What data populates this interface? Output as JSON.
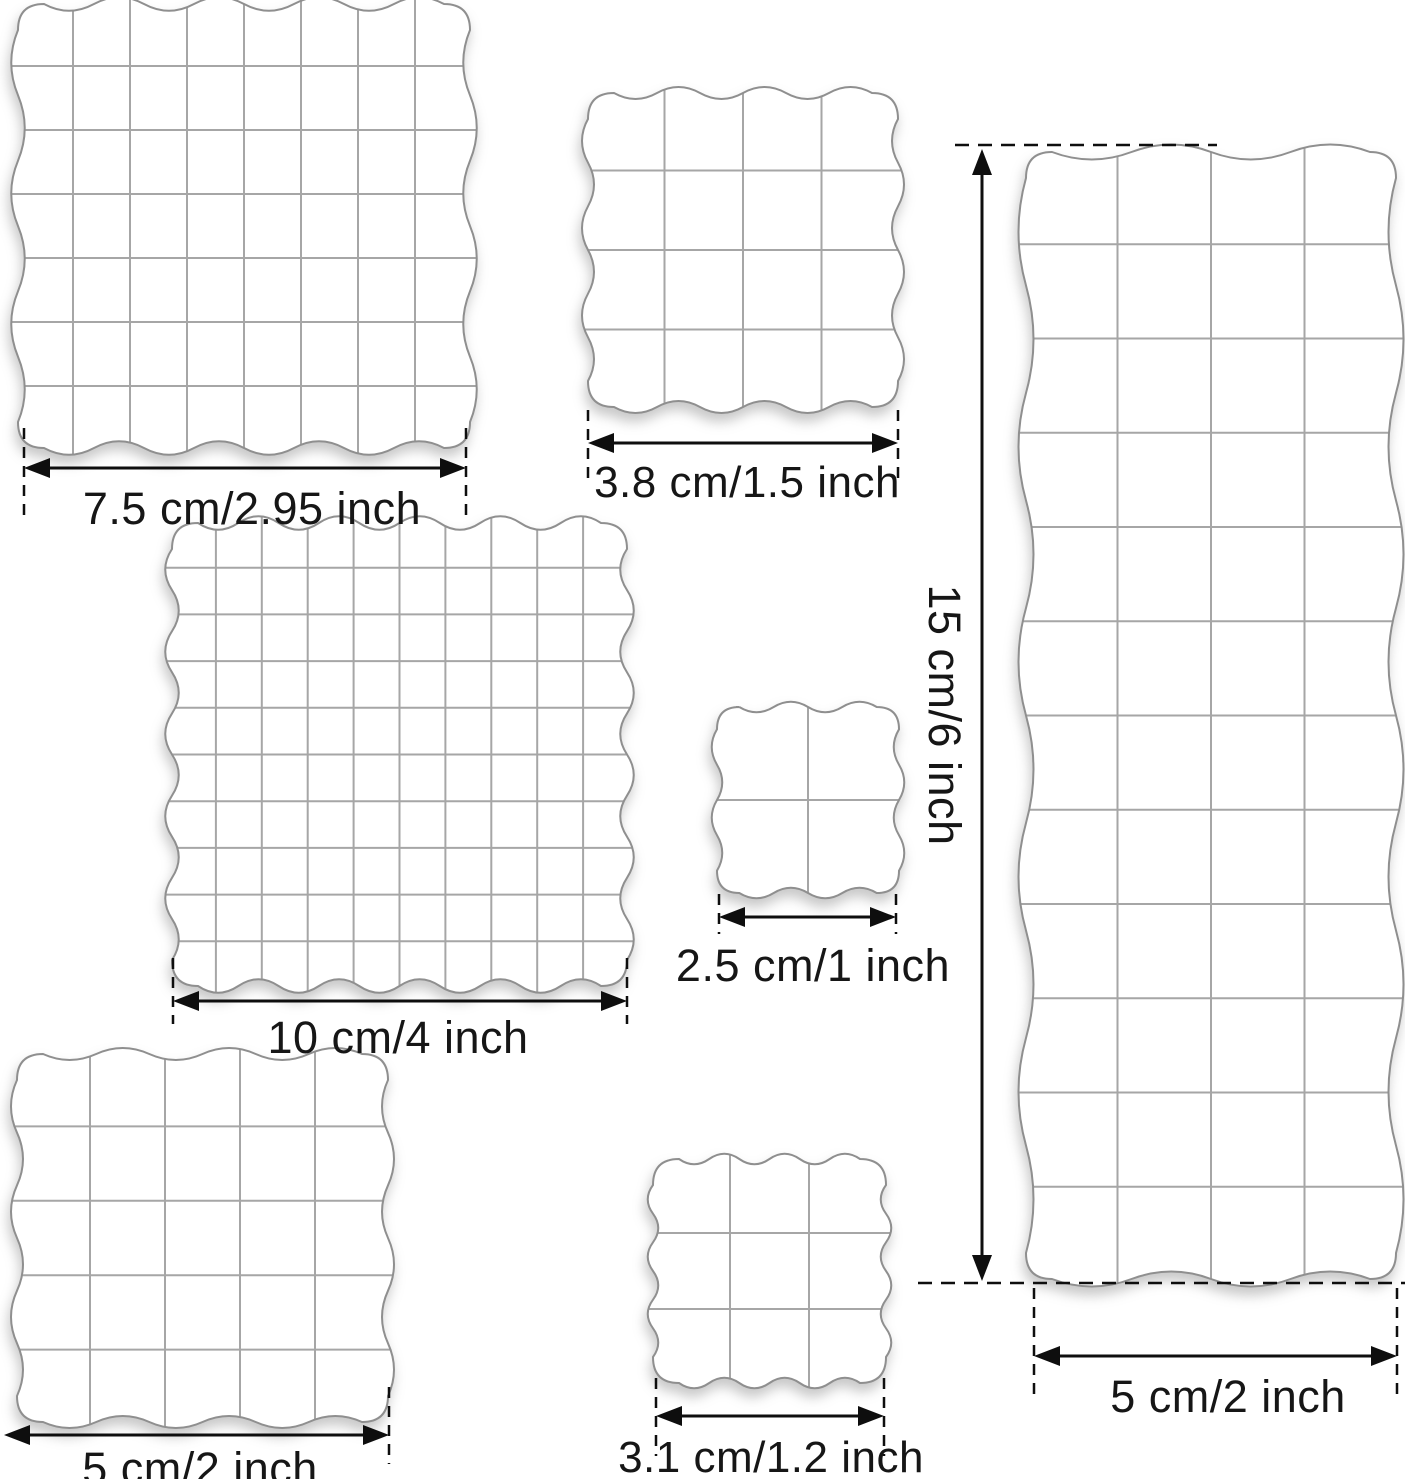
{
  "colors": {
    "background": "#ffffff",
    "line": "#0e0e0e",
    "grid": "#a6a6a6",
    "outline": "#8f8f8f",
    "block_fill": "#ffffff"
  },
  "blocks": [
    {
      "name": "block-7-5-cm",
      "x": 16,
      "y": 2,
      "w": 456,
      "h": 448,
      "cols": 8,
      "rows": 7,
      "waves_x": 4,
      "waves_y": 3,
      "amp": 9
    },
    {
      "name": "block-3-8-cm",
      "x": 586,
      "y": 91,
      "w": 314,
      "h": 318,
      "cols": 4,
      "rows": 4,
      "waves_x": 3,
      "waves_y": 3,
      "amp": 8
    },
    {
      "name": "block-15-cm",
      "x": 1024,
      "y": 150,
      "w": 374,
      "h": 1131,
      "cols": 4,
      "rows": 12,
      "waves_x": 2,
      "waves_y": 5,
      "amp": 10
    },
    {
      "name": "block-10-cm",
      "x": 170,
      "y": 521,
      "w": 459,
      "h": 467,
      "cols": 10,
      "rows": 10,
      "waves_x": 5,
      "waves_y": 5,
      "amp": 9
    },
    {
      "name": "block-2-5-cm",
      "x": 715,
      "y": 705,
      "w": 186,
      "h": 190,
      "cols": 2,
      "rows": 2,
      "waves_x": 2,
      "waves_y": 2,
      "amp": 7
    },
    {
      "name": "block-5-cm",
      "x": 15,
      "y": 1052,
      "w": 375,
      "h": 372,
      "cols": 5,
      "rows": 5,
      "waves_x": 3,
      "waves_y": 3,
      "amp": 8
    },
    {
      "name": "block-3-1-cm",
      "x": 651,
      "y": 1157,
      "w": 237,
      "h": 228,
      "cols": 3,
      "rows": 3,
      "waves_x": 3,
      "waves_y": 3,
      "amp": 7
    }
  ],
  "dimensions": [
    {
      "name": "dim-7-5-cm",
      "label": "7.5 cm/2.95 inch",
      "type": "h",
      "x1": 24,
      "x2": 466,
      "y": 468,
      "tick_y1": 428,
      "tick_y2": 518,
      "label_x": 252,
      "label_y": 484,
      "font": 45
    },
    {
      "name": "dim-3-8-cm",
      "label": "3.8 cm/1.5 inch",
      "type": "h",
      "x1": 588,
      "x2": 898,
      "y": 443,
      "tick_y1": 410,
      "tick_y2": 482,
      "label_x": 747,
      "label_y": 459,
      "font": 44
    },
    {
      "name": "dim-10-cm",
      "label": "10 cm/4 inch",
      "type": "h",
      "x1": 173,
      "x2": 627,
      "y": 1001,
      "tick_y1": 958,
      "tick_y2": 1024,
      "label_x": 398,
      "label_y": 1013,
      "font": 45
    },
    {
      "name": "dim-2-5-cm",
      "label": "2.5 cm/1 inch",
      "type": "h",
      "x1": 719,
      "x2": 896,
      "y": 917,
      "tick_y1": 894,
      "tick_y2": 934,
      "label_x": 813,
      "label_y": 941,
      "font": 45
    },
    {
      "name": "dim-5-cm-left",
      "label": "5 cm/2 inch",
      "type": "h",
      "x1": 4,
      "x2": 389,
      "y": 1435,
      "tick_y1": 1387,
      "tick_y2": 1464,
      "label_x": 200,
      "label_y": 1444,
      "font": 45,
      "no_left_tick": true
    },
    {
      "name": "dim-3-1-cm",
      "label": "3.1 cm/1.2 inch",
      "type": "h",
      "x1": 656,
      "x2": 884,
      "y": 1416,
      "tick_y1": 1378,
      "tick_y2": 1456,
      "label_x": 771,
      "label_y": 1434,
      "font": 44
    },
    {
      "name": "dim-5-cm-right",
      "label": "5 cm/2 inch",
      "type": "h",
      "x1": 1034,
      "x2": 1397,
      "y": 1356,
      "tick_y1": 1288,
      "tick_y2": 1400,
      "label_x": 1228,
      "label_y": 1372,
      "font": 45
    },
    {
      "name": "dim-15-cm",
      "label": "15 cm/6 inch",
      "type": "v",
      "x": 982,
      "y1": 149,
      "y2": 1281,
      "label_x": 944,
      "label_y": 715,
      "font": 45,
      "ext_top": {
        "x1": 955,
        "x2": 1217,
        "y": 145
      },
      "ext_bottom": {
        "x1": 918,
        "x2": 1405,
        "y": 1283
      }
    }
  ]
}
